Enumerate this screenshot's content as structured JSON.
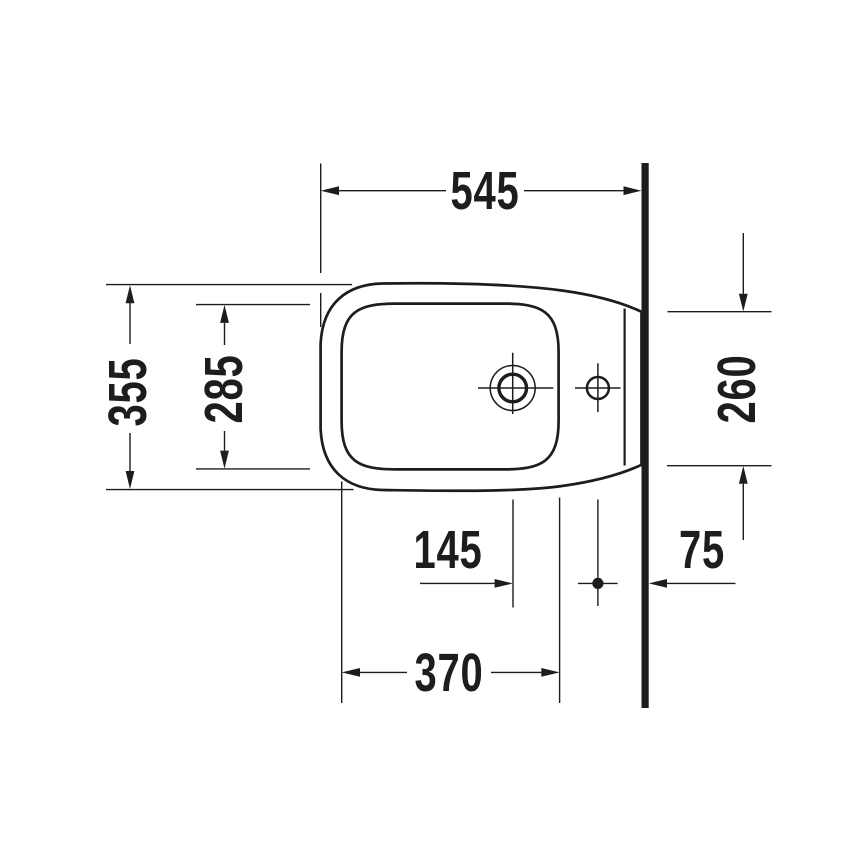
{
  "drawing": {
    "type": "technical-dimension-drawing",
    "subject": "bidet-top-view-against-wall",
    "colors": {
      "line": "#1d1d1b",
      "background": "#ffffff"
    },
    "dimensions": {
      "overall_depth": "545",
      "overall_width": "355",
      "basin_width": "285",
      "wall_contact_width": "260",
      "tap_hole_to_fixing_hole": "145",
      "fixing_hole_to_wall": "75",
      "basin_length": "370"
    }
  }
}
